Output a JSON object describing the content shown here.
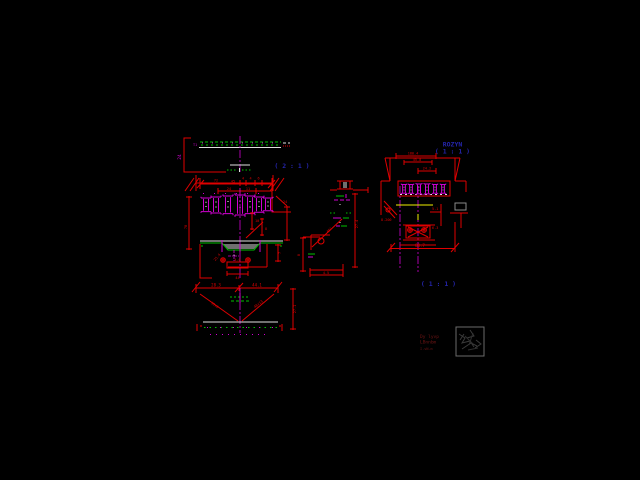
{
  "viewport": {
    "background": "#000000",
    "description": "CAD drawing viewport with steel girder fabrication detail views"
  },
  "palette": {
    "line_red": "#e00000",
    "line_magenta": "#d000d0",
    "line_green": "#00c000",
    "line_white": "#e0e0e0",
    "line_yellow": "#f0f000",
    "text_blue": "#2424aa",
    "text_dark_red": "#6e1414",
    "stamp_gray": "#909090"
  },
  "views": {
    "top_flange": {
      "scale_label": "( 2 : 1 )",
      "height_dim": "24",
      "edge_label": "T1",
      "seg_dim_1": "72",
      "seg_dim_2": "4",
      "seg_dim_3": "4",
      "seg_dim_4": "6"
    },
    "cross_section": {
      "top_dim": "45",
      "sub_dim_1": "24",
      "sub_dim_2": "11",
      "right_dim": "24",
      "left_height_dim": "78",
      "mid_dim_1": "10",
      "mid_dim_2": "8",
      "plate_dim": "25.4",
      "box_dim": "4.0",
      "under_dim": "44",
      "right_small_dim": "7"
    },
    "bottom_flange": {
      "dim_left": "28.3",
      "dim_right": "44.1",
      "diag_left_label": "30x8",
      "diag_right_label": "48x13",
      "right_height_dim": "27.1"
    },
    "side_detail": {
      "height_dim": "27.4",
      "angle_label": "45°",
      "width_dim": "4.5",
      "left_dim": "8"
    },
    "node_view": {
      "title": "ROZYN",
      "scale_label": "( 1 : 1 )",
      "dim_top": "180.4",
      "dim_mid": "45.0",
      "dim_inner": "24.2",
      "left_label": "8.200",
      "right_label": "5.1",
      "weld_label": "6.3",
      "dim_bottom": "80.7",
      "scale_label_2": "( 1 : 1 )"
    }
  },
  "title_block": {
    "line1": "Dy lyvp",
    "line2": "LBnnbm",
    "line3": "I.vN.m"
  }
}
